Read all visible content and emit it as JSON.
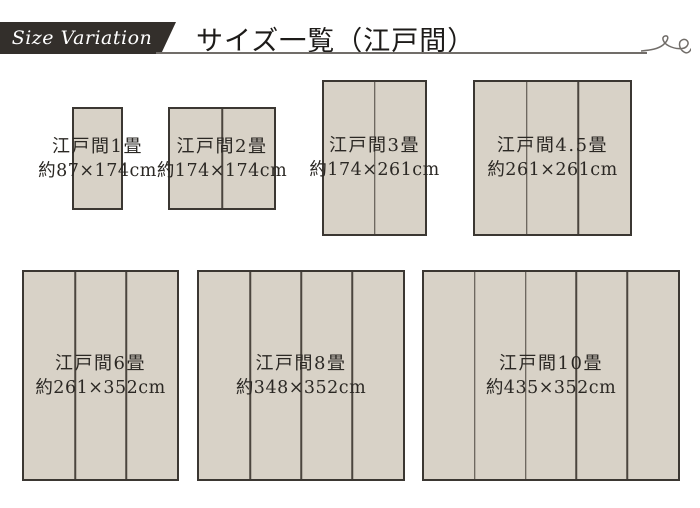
{
  "header": {
    "ribbon_label": "Size Variation",
    "title": "サイズ一覧（江戸間）"
  },
  "sizes": [
    {
      "name": "江戸間1畳",
      "dimensions": "約87×174cm",
      "panels": 1
    },
    {
      "name": "江戸間2畳",
      "dimensions": "約174×174cm",
      "panels": 2
    },
    {
      "name": "江戸間3畳",
      "dimensions": "約174×261cm",
      "panels": 2
    },
    {
      "name": "江戸間4.5畳",
      "dimensions": "約261×261cm",
      "panels": 3
    },
    {
      "name": "江戸間6畳",
      "dimensions": "約261×352cm",
      "panels": 3
    },
    {
      "name": "江戸間8畳",
      "dimensions": "約348×352cm",
      "panels": 4
    },
    {
      "name": "江戸間10畳",
      "dimensions": "約435×352cm",
      "panels": 5
    }
  ],
  "colors": {
    "mat_fill": "#d8d2c7",
    "mat_border": "#3b3732",
    "mat_divider": "#4b453e",
    "ribbon_background": "#332f2b",
    "ribbon_text": "#ffffff",
    "title_text": "#1d1b19",
    "label_text": "#2b2824",
    "rule": "#716d69"
  }
}
